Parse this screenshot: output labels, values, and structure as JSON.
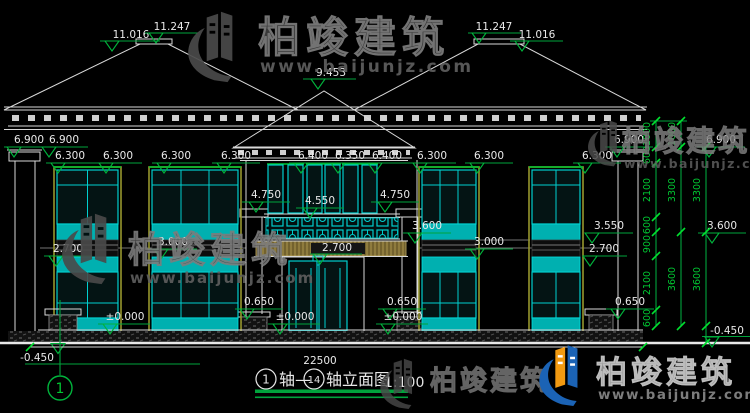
{
  "drawing": {
    "title": {
      "axis_start_bubble": "1",
      "axis_link": "轴—",
      "axis_end_bubble": "14",
      "name": "轴立面图",
      "scale": "1:100"
    },
    "overall_width_dim": "22500",
    "left_axis_bubble": "1"
  },
  "markers": [
    {
      "v": "11.016"
    },
    {
      "v": "11.247"
    },
    {
      "v": "9.453"
    },
    {
      "v": "11.247"
    },
    {
      "v": "11.016"
    },
    {
      "v": "6.900"
    },
    {
      "v": "6.900"
    },
    {
      "v": "6.300"
    },
    {
      "v": "6.300"
    },
    {
      "v": "6.300"
    },
    {
      "v": "6.300"
    },
    {
      "v": "6.400"
    },
    {
      "v": "6.350"
    },
    {
      "v": "6.400"
    },
    {
      "v": "6.300"
    },
    {
      "v": "6.300"
    },
    {
      "v": "6.300"
    },
    {
      "v": "6.900"
    },
    {
      "v": "6.900"
    },
    {
      "v": "4.750"
    },
    {
      "v": "4.550"
    },
    {
      "v": "4.750"
    },
    {
      "v": "3.600"
    },
    {
      "v": "3.550"
    },
    {
      "v": "3.600"
    },
    {
      "v": "2.700"
    },
    {
      "v": "3.000"
    },
    {
      "v": "3.000"
    },
    {
      "v": "2.700"
    },
    {
      "v": "2.700"
    },
    {
      "v": "0.650"
    },
    {
      "v": "0.650"
    },
    {
      "v": "0.650"
    },
    {
      "v": "±0.000"
    },
    {
      "v": "±0.000"
    },
    {
      "v": "±0.000"
    },
    {
      "v": "-0.450"
    },
    {
      "v": "-0.450"
    }
  ],
  "chain_dims": [
    {
      "v": "1000"
    },
    {
      "v": "600"
    },
    {
      "v": "2100"
    },
    {
      "v": "600"
    },
    {
      "v": "900"
    },
    {
      "v": "2100"
    },
    {
      "v": "600"
    },
    {
      "v": "1000"
    },
    {
      "v": "3300"
    },
    {
      "v": "3600"
    },
    {
      "v": "3300"
    },
    {
      "v": "3600"
    }
  ],
  "watermark": {
    "brand": "柏竣建筑",
    "url": "www.baijunjz.com"
  },
  "colors": {
    "dimension_green": "#00a33c",
    "window_cyan": "#00cfcf",
    "frame_olive": "#96962e",
    "balcony_khaki": "#8f7c3e",
    "logo_blue": "#1b63b5",
    "logo_orange": "#f29a11"
  }
}
